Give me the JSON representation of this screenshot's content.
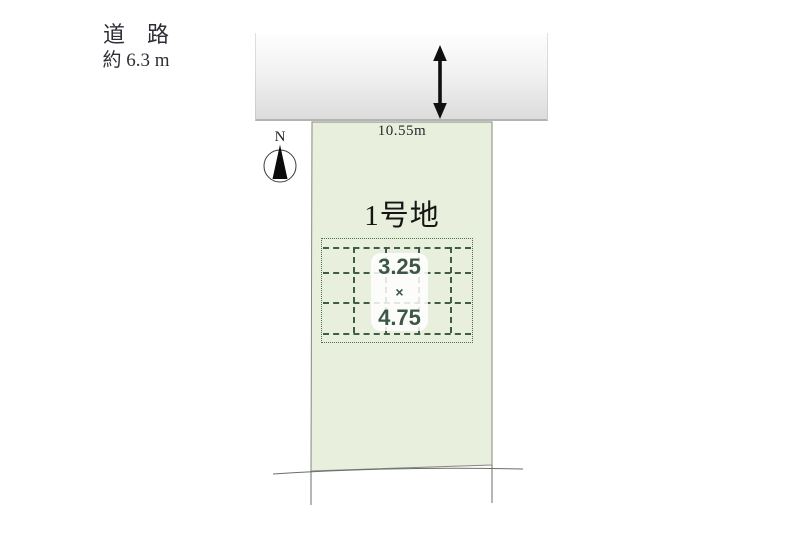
{
  "diagram": {
    "road": {
      "label": "道　路",
      "width": "約 6.3 m"
    },
    "compass": {
      "north": "N"
    },
    "parcel": {
      "frontage": "10.55m",
      "name": "1号地"
    },
    "building": {
      "width": "3.25",
      "times": "×",
      "depth": "4.75"
    },
    "colors": {
      "parcel_fill": "#e8efdc",
      "parcel_border": "#85887e",
      "grid_line": "#3e5c46",
      "dims_text": "#3c5745",
      "road_band_bottom": "#dcdcdc",
      "arrow": "#101010"
    }
  }
}
